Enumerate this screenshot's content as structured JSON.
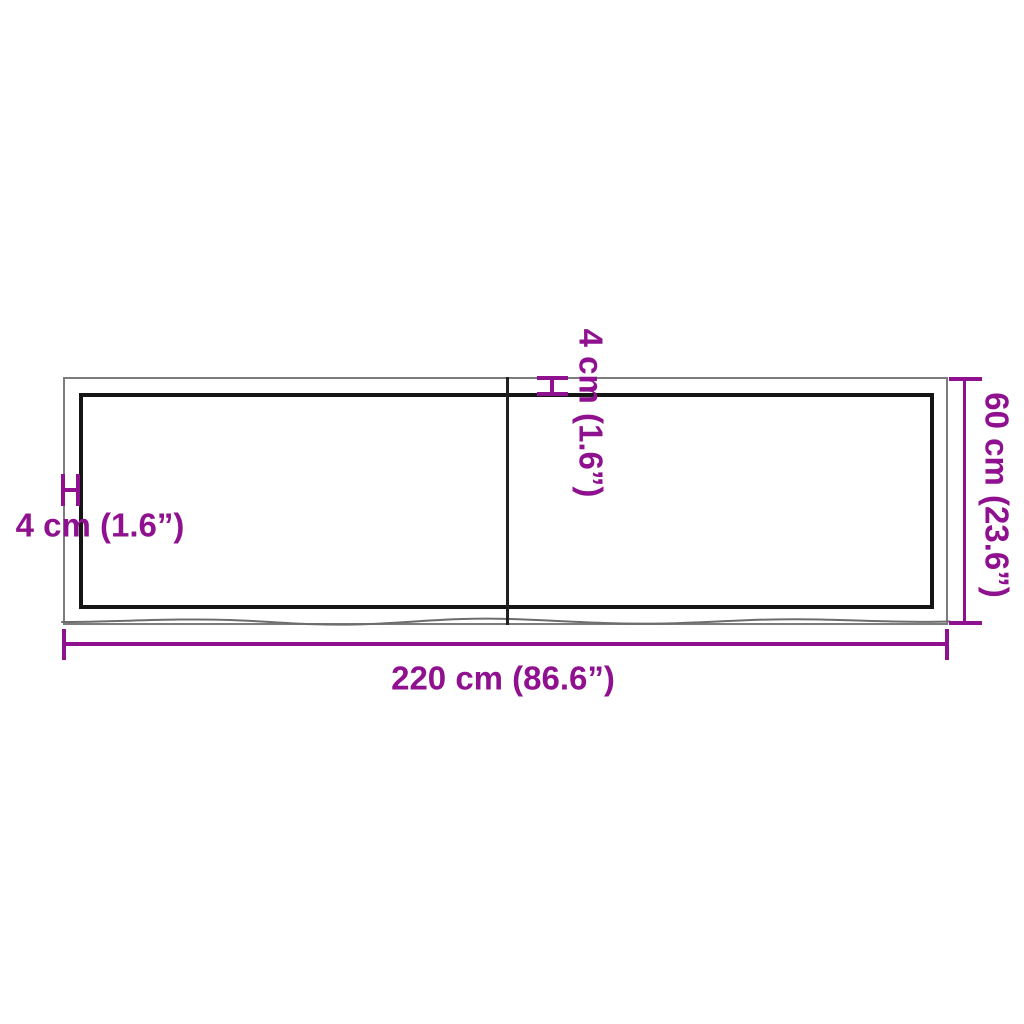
{
  "diagram": {
    "type": "product-dimension-diagram",
    "subject": "rectangular board top with center seam and live wood edge"
  },
  "dimensions": {
    "width_label": "220 cm (86.6”)",
    "height_label": "60 cm (23.6”)",
    "thickness_left_label": "4 cm (1.6”)",
    "thickness_top_label": "4 cm (1.6”)"
  },
  "colors": {
    "dimension": "#8F118F",
    "outline_outer": "#7c7c7c",
    "outline_inner": "#151515",
    "divider": "#202020",
    "wood_edge": "#6d6d6d",
    "background": "#ffffff"
  }
}
